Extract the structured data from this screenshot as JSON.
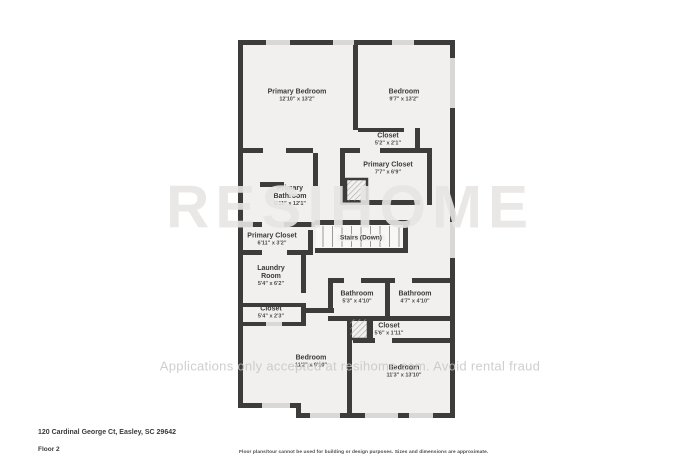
{
  "colors": {
    "wall": "#3d3c3b",
    "room_fill": "#f1f0ee",
    "window": "#d9d8d6",
    "stair_line": "#9a9998",
    "stair_fill": "#f8f7f6"
  },
  "rooms": [
    {
      "name": "Primary Bedroom",
      "dims": "12'10\" x 13'2\""
    },
    {
      "name": "Bedroom",
      "dims": "9'7\" x 13'2\""
    },
    {
      "name": "Closet",
      "dims": "5'2\" x 2'1\""
    },
    {
      "name": "Primary Closet",
      "dims": "7'7\" x 6'9\""
    },
    {
      "name": "Primary Bathroom",
      "dims": "6'11\" x 12'1\""
    },
    {
      "name": "Primary Closet",
      "dims": "6'11\" x 3'2\""
    },
    {
      "name": "Stairs (Down)",
      "dims": ""
    },
    {
      "name": "Laundry Room",
      "dims": "5'4\" x 6'2\""
    },
    {
      "name": "Closet",
      "dims": "5'4\" x 2'3\""
    },
    {
      "name": "Bathroom",
      "dims": "5'3\" x 4'10\""
    },
    {
      "name": "Bathroom",
      "dims": "4'7\" x 4'10\""
    },
    {
      "name": "Closet",
      "dims": "5'6\" x 1'11\""
    },
    {
      "name": "Bedroom",
      "dims": "11'2\" x 9'10\""
    },
    {
      "name": "Bedroom",
      "dims": "11'3\" x 13'10\""
    }
  ],
  "watermarks": {
    "logo": "RESIHOME",
    "banner": "Applications only accepted at resihome.com. Avoid rental fraud"
  },
  "footer": {
    "address": "120 Cardinal George Ct, Easley, SC 29642",
    "floor": "Floor 2",
    "disclaimer": "Floor plans/tour cannot be used for building or design purposes. Sizes and dimensions are approximate."
  }
}
